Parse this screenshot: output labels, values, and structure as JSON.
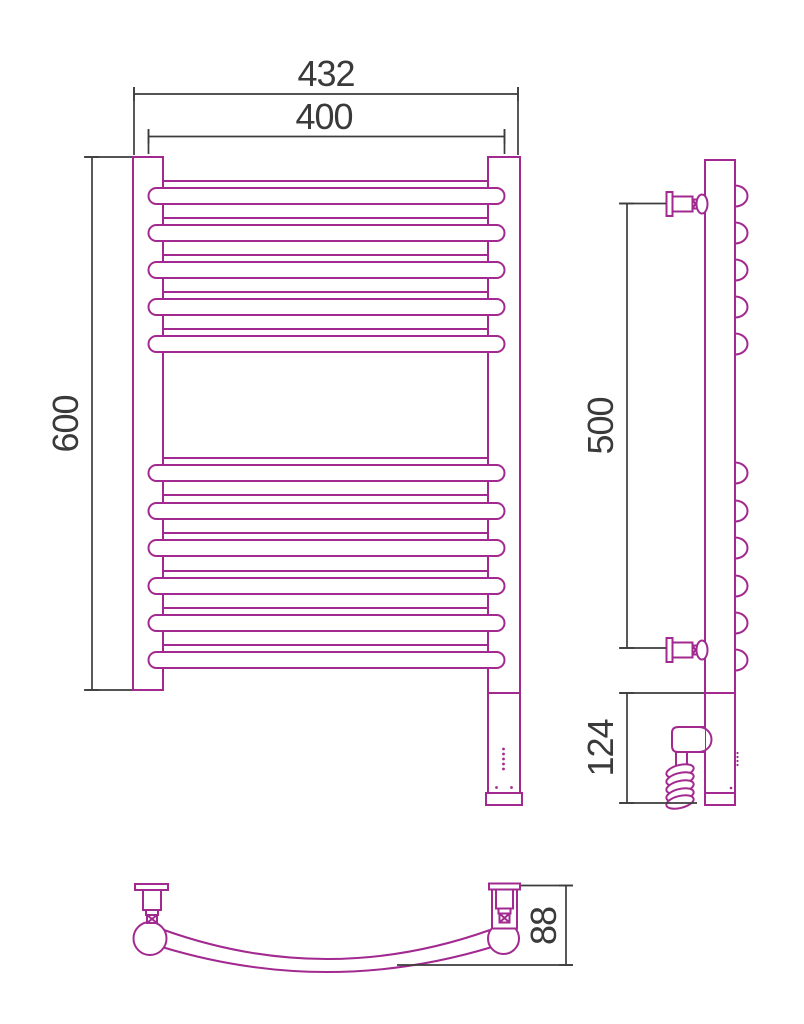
{
  "title": "Heated towel rail dimensional drawing",
  "colors": {
    "outline": "#A2298F",
    "dimension": "#3C3C3C",
    "label": "#3A3A3A",
    "background": "#FFFFFF"
  },
  "views": {
    "front": {
      "name": "front-view",
      "rail_top_group_count": 5,
      "rail_bottom_group_count": 6
    },
    "side": {
      "name": "side-view",
      "bump_count": 11,
      "valve_count": 2
    },
    "bottom": {
      "name": "bottom-view",
      "bracket_count": 2
    }
  },
  "dimensions": {
    "overall_width": "432",
    "tube_length": "400",
    "height": "600",
    "bracket_span": "500",
    "lower_section_height": "124",
    "depth": "88"
  }
}
